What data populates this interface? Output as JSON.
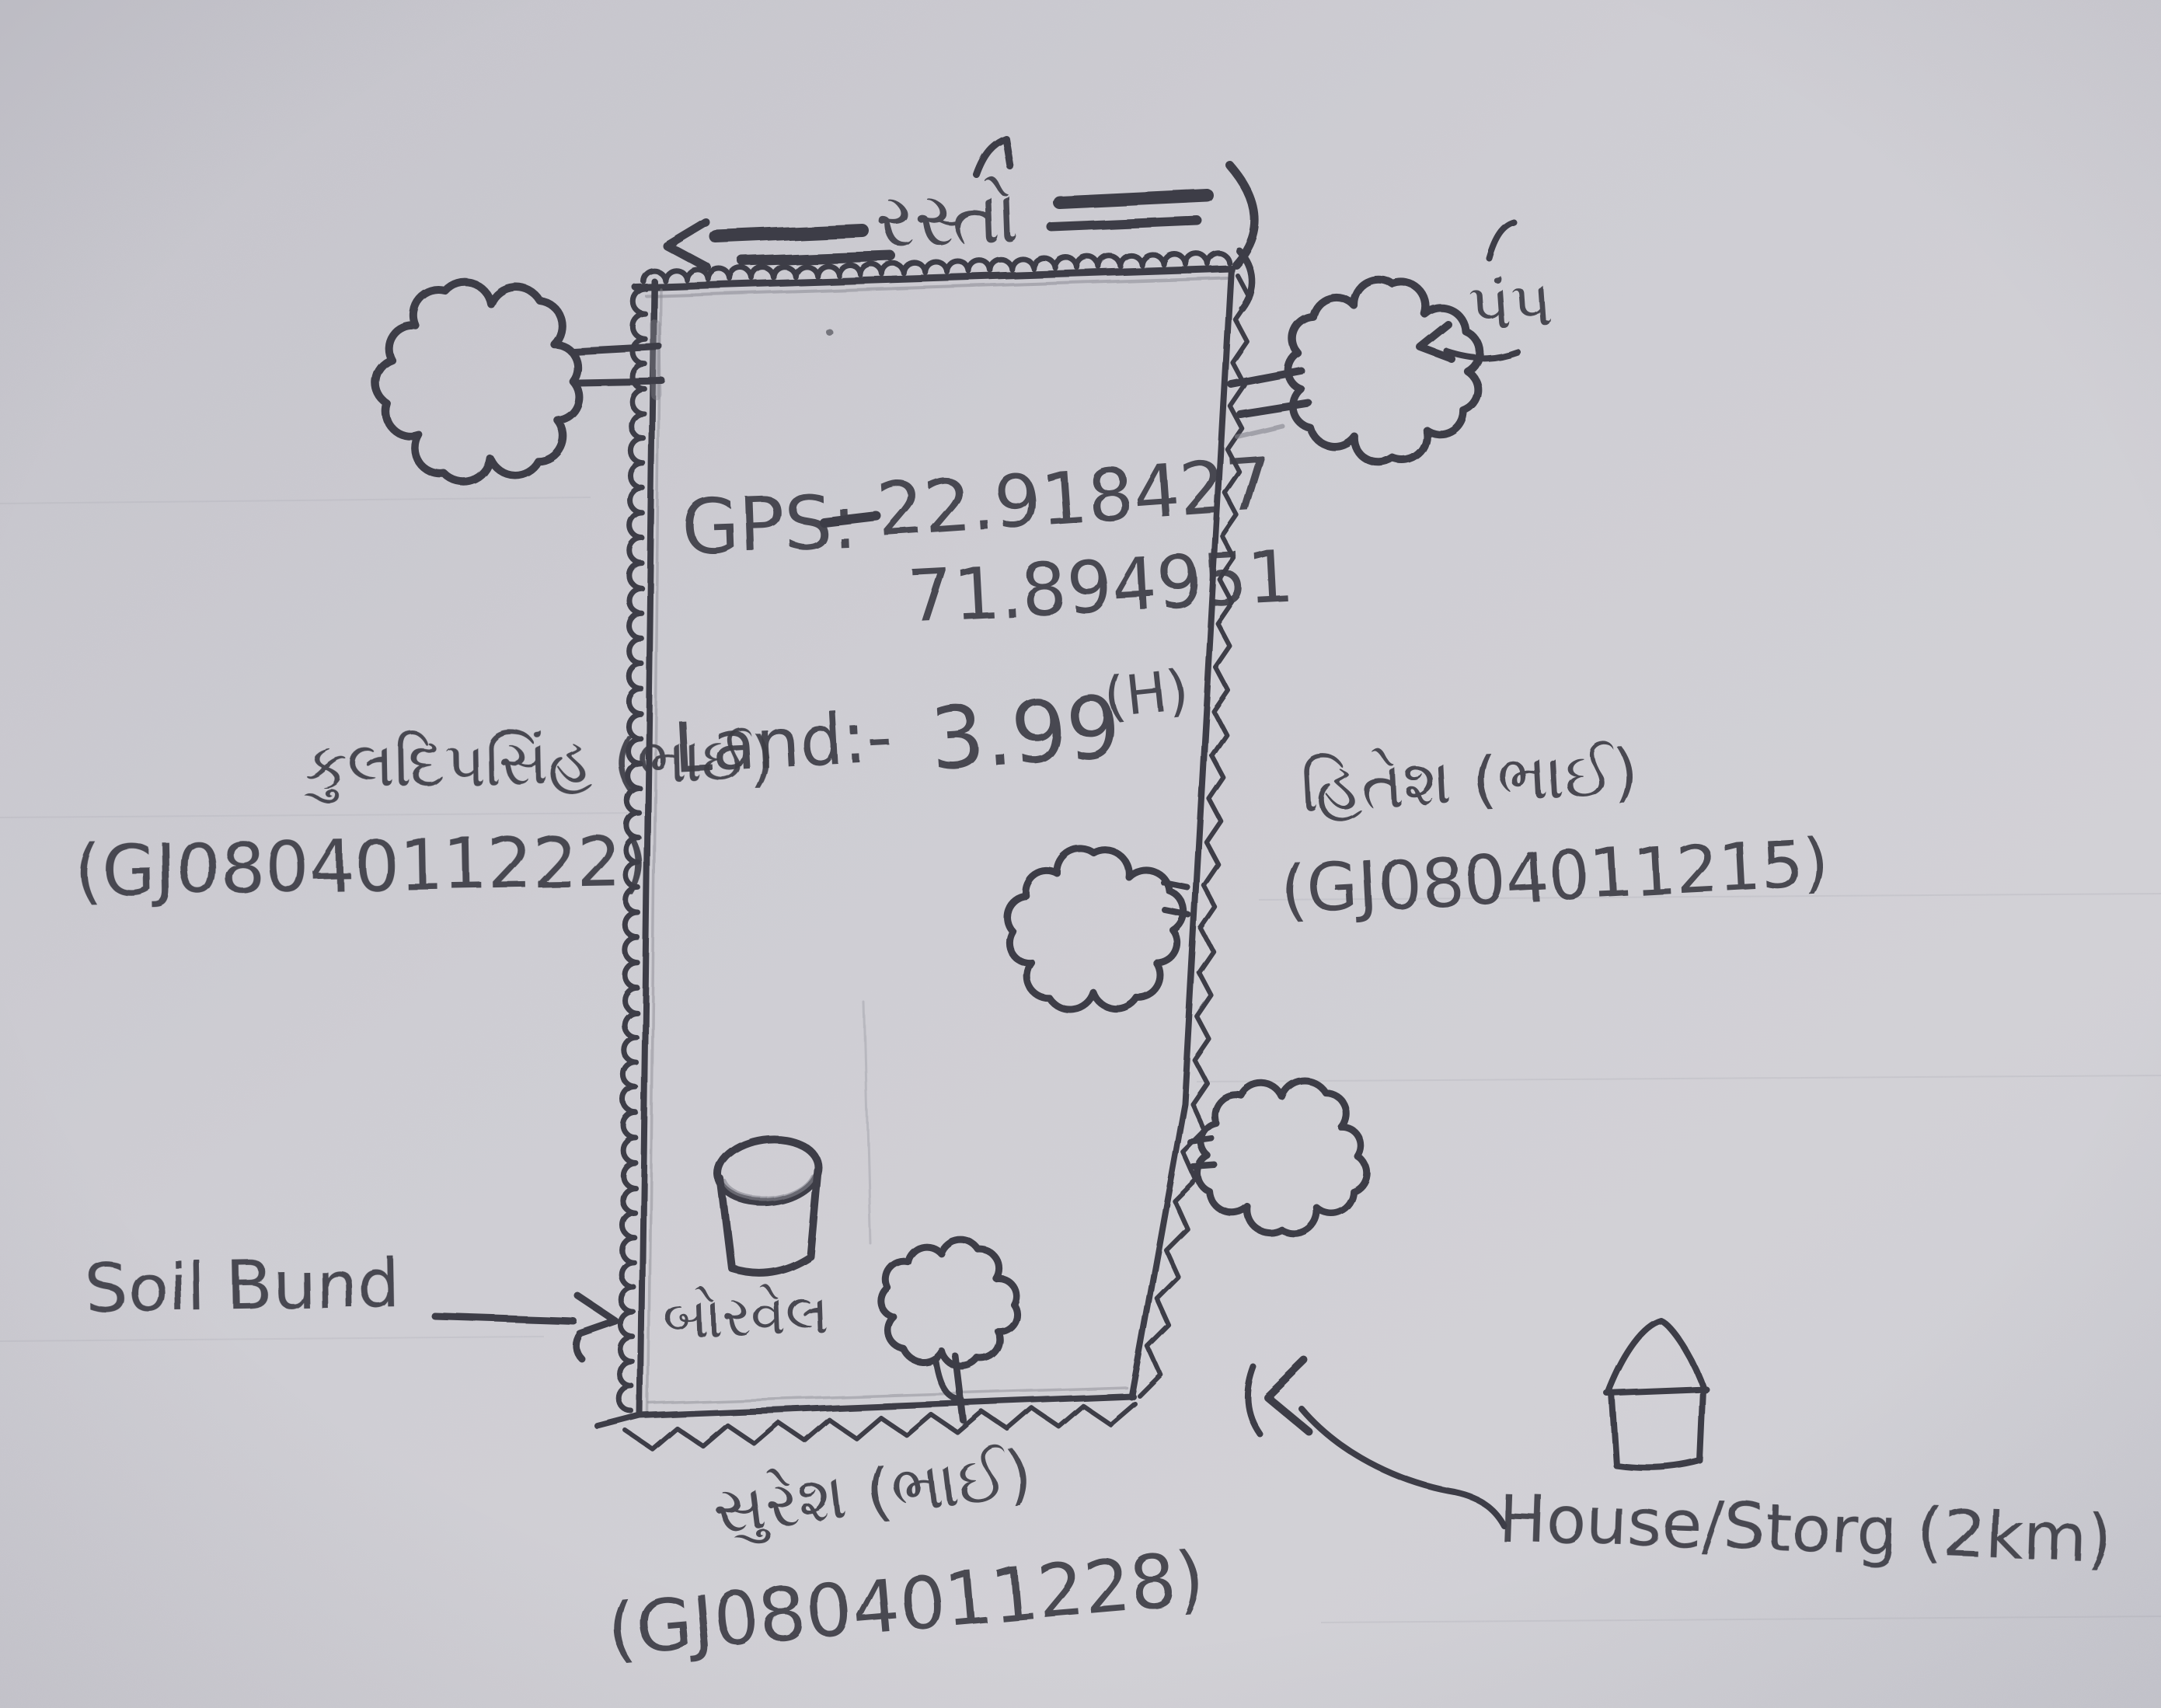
{
  "road": {
    "label": "રસ્તો"
  },
  "gps": {
    "label": "GPS:",
    "latitude": "22.918427",
    "longitude": "71.894951"
  },
  "land": {
    "label": "Land:-",
    "value": "3.99",
    "unit": "(H)"
  },
  "features": {
    "soil_bund": "Soil Bund",
    "borewell": "બોરવેલ",
    "pump": "પંપ",
    "house": "House/Storg (2km)"
  },
  "neighbors": {
    "left": {
      "name": "કુલદિપસિંહ (ભાઈ)",
      "id": "(GJ0804011222)"
    },
    "right": {
      "name": "હિતેશ (ભાઈ)",
      "id": "(GJ0804011215)"
    },
    "bottom": {
      "name": "સુરેશ (ભાઈ)",
      "id": "(GJ0804011228)"
    }
  },
  "colors": {
    "paper": "#cccbd1",
    "pencil": "#3e3e46",
    "pencil_light": "#84848e"
  }
}
